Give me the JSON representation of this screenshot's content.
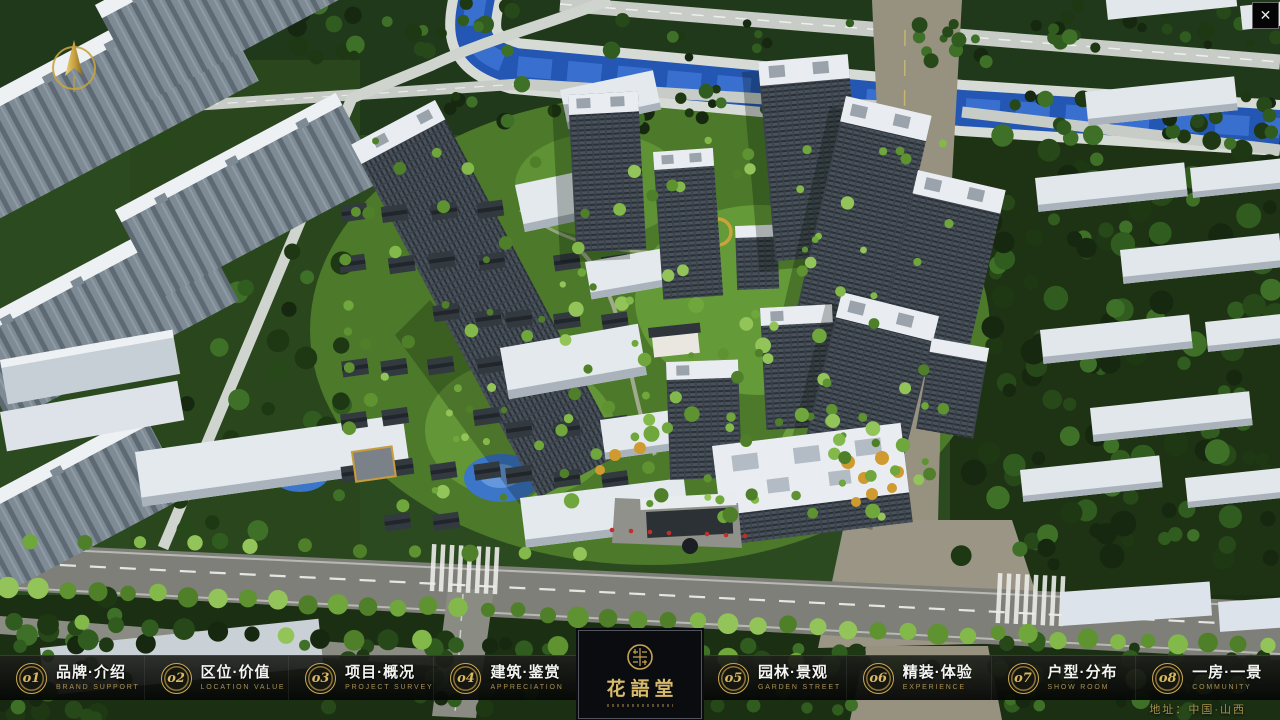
{
  "window": {
    "close_label": "✕"
  },
  "nav": {
    "items": [
      {
        "num": "o1",
        "zh": "品牌·介绍",
        "en": "BRAND SUPPORT"
      },
      {
        "num": "o2",
        "zh": "区位·价值",
        "en": "LOCATION VALUE"
      },
      {
        "num": "o3",
        "zh": "项目·概况",
        "en": "PROJECT SURVEY"
      },
      {
        "num": "o4",
        "zh": "建筑·鉴赏",
        "en": "APPRECIATION"
      },
      {
        "num": "o5",
        "zh": "园林·景观",
        "en": "GARDEN STREET"
      },
      {
        "num": "o6",
        "zh": "精装·体验",
        "en": "EXPERIENCE"
      },
      {
        "num": "o7",
        "zh": "户型·分布",
        "en": "SHOW ROOM"
      },
      {
        "num": "o8",
        "zh": "一房·一景",
        "en": "COMMUNITY"
      }
    ]
  },
  "logo": {
    "title": "花語堂"
  },
  "footer": {
    "address": "地址：中国·山西"
  },
  "colors": {
    "gold": "#c7a552",
    "panel": "#0a0c0f",
    "water": "#2456b4",
    "road_tan": "#97917f"
  }
}
